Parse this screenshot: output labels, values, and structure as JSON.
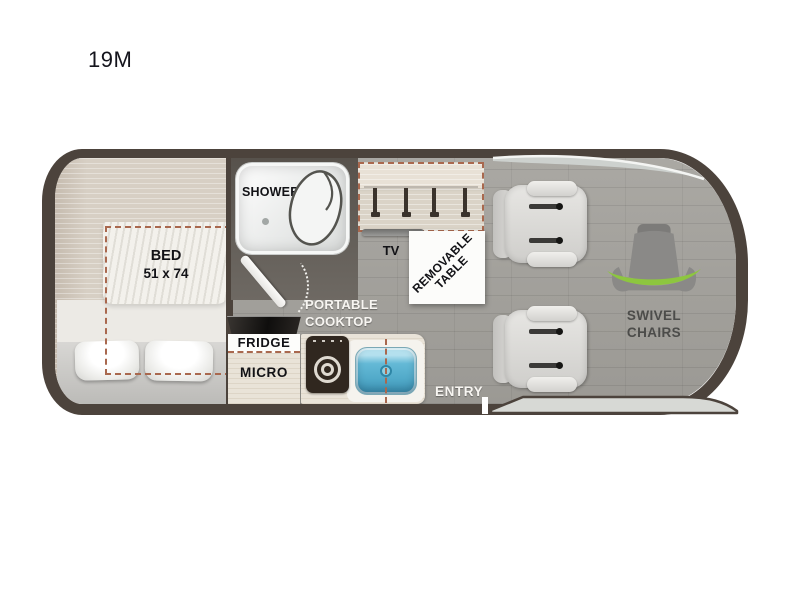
{
  "model": "19M",
  "areas": {
    "bed": {
      "label": "BED",
      "size": "51 x 74"
    },
    "shower": {
      "label": "SHOWER"
    },
    "tv": {
      "label": "TV"
    },
    "table": {
      "line1": "REMOVABLE",
      "line2": "TABLE"
    },
    "cooktop": {
      "line1": "PORTABLE",
      "line2": "COOKTOP"
    },
    "fridge": {
      "label": "FRIDGE"
    },
    "micro": {
      "label": "MICRO"
    },
    "entry": {
      "label": "ENTRY"
    },
    "swivel": {
      "line1": "SWIVEL",
      "line2": "CHAIRS"
    }
  },
  "colors": {
    "outline": "#4c433c",
    "floor": "#a3a19c",
    "beige": "#d7cfc4",
    "cream": "#e9e3d8",
    "accent": "#a9684e",
    "green": "#8dc63f",
    "sink": "#5ab3d3",
    "appliance": "#30271f",
    "icongray": "#8a8987",
    "ink": "#121216",
    "lightlabel": "#f7f5f1"
  }
}
